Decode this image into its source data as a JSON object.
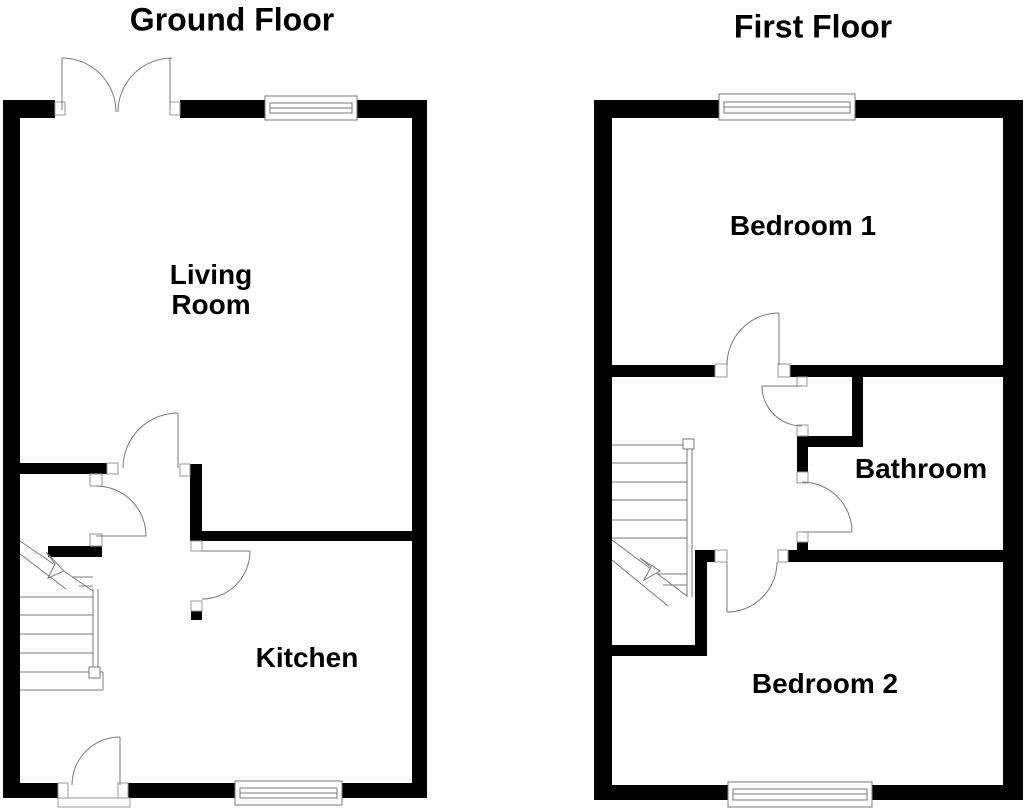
{
  "colors": {
    "background": "#ffffff",
    "wall": "#000000",
    "line": "#7a7a7a",
    "jamb_border": "#9a9a9a",
    "text": "#000000"
  },
  "floors": [
    {
      "title": "Ground Floor",
      "rooms": [
        {
          "label": "Living Room"
        },
        {
          "label": "Kitchen"
        }
      ]
    },
    {
      "title": "First Floor",
      "rooms": [
        {
          "label": "Bedroom 1"
        },
        {
          "label": "Bathroom"
        },
        {
          "label": "Bedroom 2"
        }
      ]
    }
  ]
}
